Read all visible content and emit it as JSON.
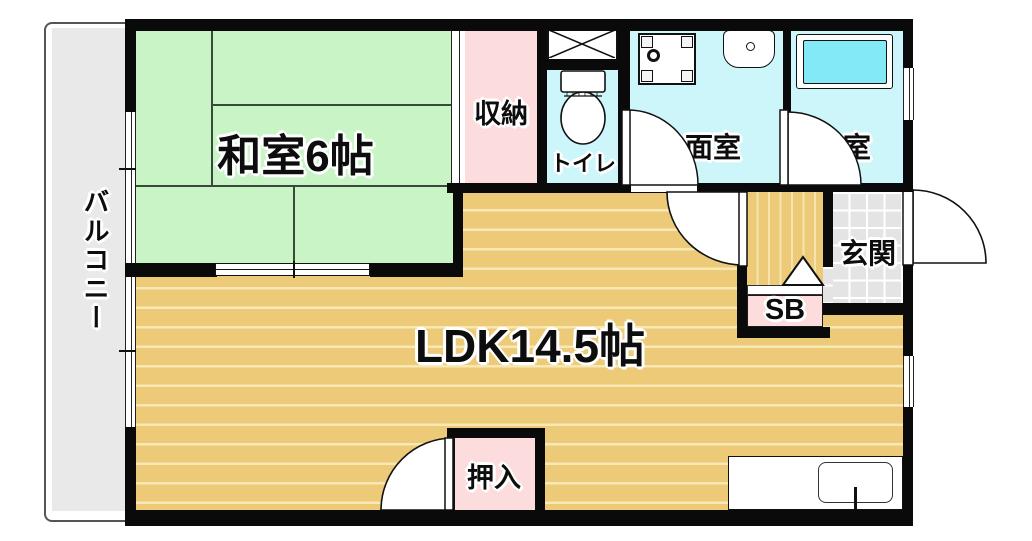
{
  "plan_title": "1LDK apartment floor plan",
  "rooms": {
    "balcony": {
      "label": "バルコニー"
    },
    "washitsu": {
      "label": "和室6帖"
    },
    "closet": {
      "label": "収納"
    },
    "toilet": {
      "label": "トイレ"
    },
    "washroom": {
      "label": "洗面室"
    },
    "bathroom": {
      "label": "浴室"
    },
    "entrance": {
      "label": "玄関"
    },
    "shoebox": {
      "label": "SB"
    },
    "ldk": {
      "label": "LDK14.5帖"
    },
    "oshiire": {
      "label": "押入"
    }
  },
  "colors": {
    "wall": "#0a0a0a",
    "tatami_green": "#c8f4c6",
    "closet_pink": "#fcdcdc",
    "wet_room_cyan": "#cdf6fb",
    "bathtub_cyan": "#84e9f6",
    "ldk_floor_tan": "#ecca78",
    "ldk_floor_line": "#f7e8b6",
    "entrance_tile_gray": "#e4e4e4",
    "balcony_gray": "#e9e9e9"
  },
  "icons": [
    "toilet-icon",
    "washing-machine-pan-icon",
    "vanity-sink-icon",
    "bathtub-icon",
    "kitchen-sink-icon",
    "door-swing-arc",
    "sliding-door",
    "window",
    "step-triangle-marker",
    "crossed-box-icon"
  ]
}
